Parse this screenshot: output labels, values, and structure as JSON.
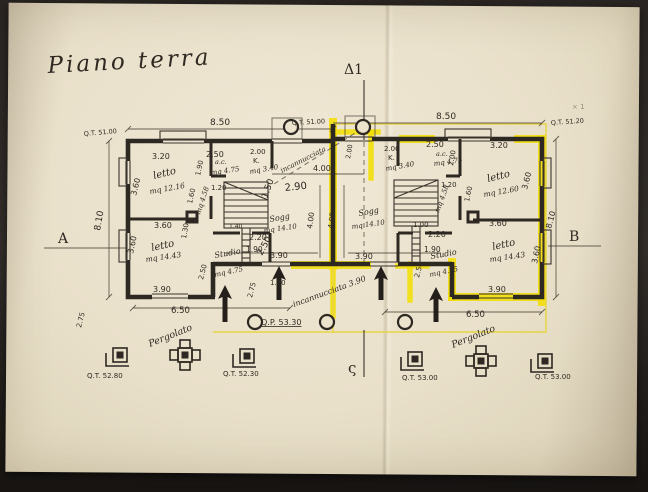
{
  "document": {
    "kind": "photographed hand-drawn architectural floor plan",
    "title": "Piano terra",
    "language": "Italian"
  },
  "colors": {
    "paper": "#e9e0ca",
    "ink": "#2e2822",
    "highlighter": "#f2de04",
    "highlight_box": "#e6d542",
    "photo_background": "#2a2522"
  },
  "section_markers": {
    "left": "A",
    "right": "B",
    "top": "Δ1",
    "bottom": "ς"
  },
  "plan": {
    "labels": [
      {
        "t": "Piano terra",
        "x": 48,
        "y": 73,
        "s": 23,
        "c": "title",
        "r": -3,
        "n": "drawing-title"
      },
      {
        "t": "Δ1",
        "x": 344,
        "y": 74,
        "s": 14,
        "c": "big",
        "n": "section-marker-top"
      },
      {
        "t": "A",
        "x": 58,
        "y": 243,
        "s": 14,
        "c": "big",
        "n": "section-marker-a"
      },
      {
        "t": "B",
        "x": 569,
        "y": 241,
        "s": 14,
        "c": "big",
        "n": "section-marker-b"
      },
      {
        "t": "ς",
        "x": 348,
        "y": 373,
        "s": 15,
        "c": "big",
        "n": "section-marker-bottom"
      },
      {
        "t": "Q.T. 51.00",
        "x": 84,
        "y": 136,
        "s": 6.5,
        "c": "dim",
        "r": -5,
        "n": "elevation-label"
      },
      {
        "t": "8.50",
        "x": 210,
        "y": 125,
        "s": 9,
        "c": "dim",
        "n": "dim-label"
      },
      {
        "t": "Q.T. 51.00",
        "x": 292,
        "y": 125,
        "s": 6.5,
        "c": "dim",
        "r": -3,
        "n": "elevation-label"
      },
      {
        "t": "8.50",
        "x": 436,
        "y": 119,
        "s": 9,
        "c": "dim",
        "n": "dim-label"
      },
      {
        "t": "Q.T. 51.20",
        "x": 551,
        "y": 125,
        "s": 6.5,
        "c": "dim",
        "r": -4,
        "n": "elevation-label"
      },
      {
        "t": "× 1",
        "x": 572,
        "y": 109,
        "s": 7,
        "c": "dim",
        "o": 0.45,
        "n": "pencil-mark"
      },
      {
        "t": "8.10",
        "x": 100,
        "y": 231,
        "s": 9,
        "c": "dim",
        "r": -80,
        "n": "dim-label"
      },
      {
        "t": "8.10",
        "x": 551,
        "y": 229,
        "s": 8,
        "c": "dim",
        "r": -75,
        "n": "dim-label"
      },
      {
        "t": "3.20",
        "x": 152,
        "y": 159,
        "s": 8,
        "c": "dim",
        "n": "dim-label"
      },
      {
        "t": "letto",
        "x": 154,
        "y": 179,
        "s": 10,
        "c": "hand",
        "r": -14,
        "n": "room-label-letto"
      },
      {
        "t": "mq 12.16",
        "x": 150,
        "y": 194,
        "s": 7.5,
        "c": "hand",
        "r": -10,
        "n": "area-label"
      },
      {
        "t": "3.60",
        "x": 136,
        "y": 196,
        "s": 8,
        "c": "dim",
        "r": -76,
        "n": "dim-label"
      },
      {
        "t": "2.50",
        "x": 206,
        "y": 157,
        "s": 8,
        "c": "dim",
        "n": "dim-label"
      },
      {
        "t": "1.90",
        "x": 200,
        "y": 176,
        "s": 7,
        "c": "dim",
        "r": -78,
        "n": "dim-label"
      },
      {
        "t": "a.c.",
        "x": 215,
        "y": 164,
        "s": 6.5,
        "c": "hand",
        "n": "room-label-ac"
      },
      {
        "t": "mq 4.75",
        "x": 211,
        "y": 175,
        "s": 7,
        "c": "hand",
        "r": -8,
        "n": "area-label"
      },
      {
        "t": "2.00",
        "x": 250,
        "y": 154,
        "s": 7,
        "c": "dim",
        "n": "dim-label"
      },
      {
        "t": "K.",
        "x": 253,
        "y": 163,
        "s": 7,
        "c": "dim",
        "n": "room-label-kitchen"
      },
      {
        "t": "mq 3.40",
        "x": 250,
        "y": 174,
        "s": 7,
        "c": "hand",
        "r": -10,
        "n": "area-label"
      },
      {
        "t": "1.20",
        "x": 211,
        "y": 190,
        "s": 7,
        "c": "dim",
        "n": "dim-label"
      },
      {
        "t": "1.60",
        "x": 192,
        "y": 204,
        "s": 7,
        "c": "dim",
        "r": -78,
        "n": "dim-label"
      },
      {
        "t": "mq 4.58",
        "x": 200,
        "y": 215,
        "s": 7,
        "c": "hand",
        "r": -72,
        "n": "area-label"
      },
      {
        "t": "1.50",
        "x": 267,
        "y": 199,
        "s": 9,
        "c": "dim",
        "r": -70,
        "n": "dim-label"
      },
      {
        "t": "2.90",
        "x": 285,
        "y": 191,
        "s": 10,
        "c": "dim",
        "r": -6,
        "n": "dim-label"
      },
      {
        "t": "1.40",
        "x": 229,
        "y": 228,
        "s": 6,
        "c": "dim",
        "n": "dim-label"
      },
      {
        "t": "Sogg",
        "x": 270,
        "y": 222,
        "s": 8,
        "c": "hand",
        "r": -10,
        "n": "room-label-soggiorno"
      },
      {
        "t": "mq 14.10",
        "x": 264,
        "y": 233,
        "s": 7,
        "c": "hand",
        "r": -8,
        "n": "area-label"
      },
      {
        "t": "1.30",
        "x": 186,
        "y": 239,
        "s": 7,
        "c": "dim",
        "r": -80,
        "n": "dim-label"
      },
      {
        "t": "3.60",
        "x": 154,
        "y": 228,
        "s": 8,
        "c": "dim",
        "n": "dim-label"
      },
      {
        "t": "letto",
        "x": 152,
        "y": 251,
        "s": 10,
        "c": "hand",
        "r": -12,
        "n": "room-label-letto"
      },
      {
        "t": "mq 14.43",
        "x": 146,
        "y": 262,
        "s": 7.5,
        "c": "hand",
        "r": -8,
        "n": "area-label"
      },
      {
        "t": "3.60",
        "x": 133,
        "y": 254,
        "s": 8,
        "c": "dim",
        "r": -78,
        "n": "dim-label"
      },
      {
        "t": "2.20",
        "x": 249,
        "y": 240,
        "s": 8,
        "c": "dim",
        "n": "dim-label"
      },
      {
        "t": "1.90",
        "x": 246,
        "y": 252,
        "s": 7.5,
        "c": "dim",
        "n": "dim-label"
      },
      {
        "t": "2.50",
        "x": 262,
        "y": 256,
        "s": 9,
        "c": "dim",
        "r": -62,
        "n": "dim-label"
      },
      {
        "t": "Studio",
        "x": 215,
        "y": 258,
        "s": 8,
        "c": "hand",
        "r": -10,
        "n": "room-label-studio"
      },
      {
        "t": "mq 4.75",
        "x": 215,
        "y": 277,
        "s": 7,
        "c": "hand",
        "r": -12,
        "n": "area-label"
      },
      {
        "t": "2.50",
        "x": 203,
        "y": 280,
        "s": 7,
        "c": "dim",
        "r": -76,
        "n": "dim-label"
      },
      {
        "t": "3.90",
        "x": 153,
        "y": 292,
        "s": 8,
        "c": "dim",
        "n": "dim-label"
      },
      {
        "t": "6.50",
        "x": 171,
        "y": 313,
        "s": 8.5,
        "c": "dim",
        "n": "dim-label"
      },
      {
        "t": "2.75",
        "x": 81,
        "y": 328,
        "s": 7,
        "c": "dim",
        "r": -76,
        "n": "dim-label"
      },
      {
        "t": "2.75",
        "x": 252,
        "y": 298,
        "s": 7,
        "c": "dim",
        "r": -76,
        "n": "dim-label"
      },
      {
        "t": "incannucciata",
        "x": 282,
        "y": 173,
        "s": 7,
        "c": "hand",
        "r": -27,
        "n": "note-label"
      },
      {
        "t": "4.00",
        "x": 313,
        "y": 171,
        "s": 8,
        "c": "dim",
        "n": "dim-label"
      },
      {
        "t": "2.00",
        "x": 350,
        "y": 159,
        "s": 6.5,
        "c": "dim",
        "r": -80,
        "n": "dim-label"
      },
      {
        "t": "4.00",
        "x": 312,
        "y": 229,
        "s": 7.5,
        "c": "dim",
        "r": -82,
        "n": "dim-label"
      },
      {
        "t": "4.00",
        "x": 333,
        "y": 229,
        "s": 7.5,
        "c": "dim",
        "r": -82,
        "n": "dim-label"
      },
      {
        "t": "3.90",
        "x": 270,
        "y": 258,
        "s": 8,
        "c": "dim",
        "n": "dim-label"
      },
      {
        "t": "1.90",
        "x": 270,
        "y": 285,
        "s": 7,
        "c": "dim",
        "n": "dim-label"
      },
      {
        "t": "3.90",
        "x": 355,
        "y": 259,
        "s": 8,
        "c": "dim",
        "n": "dim-label"
      },
      {
        "t": "incannucciata 3.90",
        "x": 294,
        "y": 307,
        "s": 8,
        "c": "hand",
        "r": -20,
        "n": "note-label"
      },
      {
        "t": "Q.P. 53.30",
        "x": 261,
        "y": 325,
        "s": 8,
        "c": "dim",
        "u": 1,
        "n": "elevation-label"
      },
      {
        "t": "2.00",
        "x": 384,
        "y": 151,
        "s": 7,
        "c": "dim",
        "n": "dim-label"
      },
      {
        "t": "K.",
        "x": 388,
        "y": 160,
        "s": 7,
        "c": "dim",
        "n": "room-label-kitchen"
      },
      {
        "t": "mq 3.40",
        "x": 386,
        "y": 171,
        "s": 7,
        "c": "hand",
        "r": -10,
        "n": "area-label"
      },
      {
        "t": "2.50",
        "x": 426,
        "y": 147,
        "s": 8,
        "c": "dim",
        "n": "dim-label"
      },
      {
        "t": "a.c.",
        "x": 436,
        "y": 156,
        "s": 6.5,
        "c": "hand",
        "n": "room-label-ac"
      },
      {
        "t": "mq 4.75",
        "x": 434,
        "y": 166,
        "s": 7,
        "c": "hand",
        "r": -8,
        "n": "area-label"
      },
      {
        "t": "3.20",
        "x": 490,
        "y": 148,
        "s": 8,
        "c": "dim",
        "n": "dim-label"
      },
      {
        "t": "letto",
        "x": 488,
        "y": 182,
        "s": 10,
        "c": "hand",
        "r": -14,
        "n": "room-label-letto"
      },
      {
        "t": "mq 12.60",
        "x": 484,
        "y": 197,
        "s": 7.5,
        "c": "hand",
        "r": -10,
        "n": "area-label"
      },
      {
        "t": "3.60",
        "x": 527,
        "y": 190,
        "s": 8,
        "c": "dim",
        "r": -76,
        "n": "dim-label"
      },
      {
        "t": "2.00",
        "x": 453,
        "y": 166,
        "s": 7,
        "c": "dim",
        "r": -80,
        "n": "dim-label"
      },
      {
        "t": "1.20",
        "x": 441,
        "y": 187,
        "s": 7,
        "c": "dim",
        "n": "dim-label"
      },
      {
        "t": "1.60",
        "x": 469,
        "y": 202,
        "s": 7,
        "c": "dim",
        "r": -78,
        "n": "dim-label"
      },
      {
        "t": "mq 4.58",
        "x": 439,
        "y": 213,
        "s": 7,
        "c": "hand",
        "r": -70,
        "n": "area-label"
      },
      {
        "t": "1.00",
        "x": 413,
        "y": 227,
        "s": 7,
        "c": "dim",
        "n": "dim-label"
      },
      {
        "t": "Sogg",
        "x": 359,
        "y": 216,
        "s": 8,
        "c": "hand",
        "r": -10,
        "n": "room-label-soggiorno"
      },
      {
        "t": "mq 14.10",
        "x": 352,
        "y": 229,
        "s": 7,
        "c": "hand",
        "r": -8,
        "n": "area-label"
      },
      {
        "t": "2.20",
        "x": 428,
        "y": 237,
        "s": 8,
        "c": "dim",
        "n": "dim-label"
      },
      {
        "t": "1.90",
        "x": 424,
        "y": 252,
        "s": 7.5,
        "c": "dim",
        "n": "dim-label"
      },
      {
        "t": "Studio",
        "x": 431,
        "y": 259,
        "s": 8,
        "c": "hand",
        "r": -10,
        "n": "room-label-studio"
      },
      {
        "t": "mq 4.75",
        "x": 430,
        "y": 277,
        "s": 7,
        "c": "hand",
        "r": -12,
        "n": "area-label"
      },
      {
        "t": "2.50",
        "x": 419,
        "y": 278,
        "s": 7,
        "c": "dim",
        "r": -76,
        "n": "dim-label"
      },
      {
        "t": "3.60",
        "x": 489,
        "y": 226,
        "s": 8,
        "c": "dim",
        "n": "dim-label"
      },
      {
        "t": "letto",
        "x": 493,
        "y": 250,
        "s": 10,
        "c": "hand",
        "r": -12,
        "n": "room-label-letto"
      },
      {
        "t": "mq 14.43",
        "x": 490,
        "y": 262,
        "s": 7.5,
        "c": "hand",
        "r": -8,
        "n": "area-label"
      },
      {
        "t": "3.60",
        "x": 537,
        "y": 264,
        "s": 8,
        "c": "dim",
        "r": -78,
        "n": "dim-label"
      },
      {
        "t": "3.90",
        "x": 488,
        "y": 292,
        "s": 8,
        "c": "dim",
        "n": "dim-label"
      },
      {
        "t": "6.50",
        "x": 466,
        "y": 317,
        "s": 8.5,
        "c": "dim",
        "n": "dim-label"
      },
      {
        "t": "Pergolato",
        "x": 150,
        "y": 347,
        "s": 9.5,
        "c": "hand",
        "r": -22,
        "n": "note-label-pergolato"
      },
      {
        "t": "Pergolato",
        "x": 453,
        "y": 348,
        "s": 9.5,
        "c": "hand",
        "r": -22,
        "n": "note-label-pergolato"
      },
      {
        "t": "Q.T. 52.80",
        "x": 87,
        "y": 378,
        "s": 7,
        "c": "dim",
        "n": "elevation-label"
      },
      {
        "t": "Q.T. 52.30",
        "x": 223,
        "y": 376,
        "s": 7,
        "c": "dim",
        "n": "elevation-label"
      },
      {
        "t": "Q.T. 53.00",
        "x": 402,
        "y": 380,
        "s": 7,
        "c": "dim",
        "n": "elevation-label"
      },
      {
        "t": "Q.T. 53.00",
        "x": 535,
        "y": 379,
        "s": 7,
        "c": "dim",
        "n": "elevation-label"
      }
    ],
    "pillars": [
      {
        "type": "L",
        "x": 113,
        "y": 348
      },
      {
        "type": "cross",
        "x": 178,
        "y": 348
      },
      {
        "type": "L",
        "x": 240,
        "y": 349
      },
      {
        "type": "L",
        "x": 408,
        "y": 352
      },
      {
        "type": "cross",
        "x": 474,
        "y": 354
      },
      {
        "type": "L",
        "x": 538,
        "y": 354
      }
    ],
    "columns": [
      {
        "x": 291,
        "y": 127
      },
      {
        "x": 363,
        "y": 127
      },
      {
        "x": 255,
        "y": 322
      },
      {
        "x": 327,
        "y": 322
      },
      {
        "x": 405,
        "y": 322
      }
    ],
    "arrows": [
      {
        "x": 225,
        "tip": 285,
        "base": 322
      },
      {
        "x": 279,
        "tip": 266,
        "base": 300
      },
      {
        "x": 381,
        "tip": 266,
        "base": 300
      },
      {
        "x": 436,
        "tip": 287,
        "base": 322
      }
    ]
  }
}
